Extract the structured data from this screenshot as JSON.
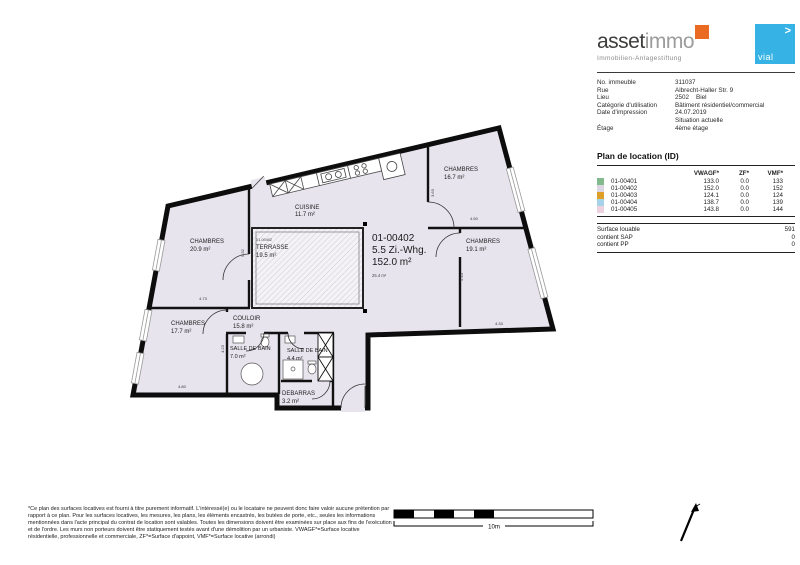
{
  "brand": {
    "wordmark_primary": "asset",
    "wordmark_secondary": "immo",
    "tagline": "Immobilien-Anlagestiftung",
    "accent_color": "#e96a20",
    "partner": {
      "text": "vial",
      "arrow": ">",
      "color": "#36b3e4"
    }
  },
  "property_info": {
    "rows": [
      {
        "label": "No. immeuble",
        "value": "311037"
      },
      {
        "label": "Rue",
        "value": "Albrecht-Haller Str. 9"
      },
      {
        "label": "Lieu",
        "value": "2502    Biel"
      },
      {
        "label": "Catégorie d'utilisation",
        "value": "Bâtiment résidentiel/commercial"
      },
      {
        "label": "Date d'impression",
        "value": "24.07.2019"
      },
      {
        "label": "",
        "value": "Situation actuelle"
      },
      {
        "label": "Étage",
        "value": "4ème étage"
      }
    ]
  },
  "location_table": {
    "title": "Plan de location (ID)",
    "columns": [
      "VWAGF*",
      "ZF*",
      "VMF*"
    ],
    "rows": [
      {
        "id": "01-00401",
        "color": "#82ba8e",
        "vwagf": "133.0",
        "zf": "0.0",
        "vmf": "133"
      },
      {
        "id": "01-00402",
        "color": "#dbd6e3",
        "vwagf": "152.0",
        "zf": "0.0",
        "vmf": "152"
      },
      {
        "id": "01-00403",
        "color": "#dd9f27",
        "vwagf": "124.1",
        "zf": "0.0",
        "vmf": "124"
      },
      {
        "id": "01-00404",
        "color": "#a6d3ea",
        "vwagf": "138.7",
        "zf": "0.0",
        "vmf": "139"
      },
      {
        "id": "01-00405",
        "color": "#ecd2de",
        "vwagf": "143.8",
        "zf": "0.0",
        "vmf": "144"
      }
    ],
    "summary": [
      {
        "label": "Surface louable",
        "value": "591"
      },
      {
        "label": "contient SAP",
        "value": "0"
      },
      {
        "label": "contient PP",
        "value": "0"
      }
    ]
  },
  "plan": {
    "unit": {
      "id": "01-00402",
      "type": "5.5 Zi.-Whg.",
      "area": "152.0 m²",
      "sub_area": "25.4 m²"
    },
    "rooms": [
      {
        "name": "CHAMBRES",
        "area": "20.9 m²"
      },
      {
        "name": "CUISINE",
        "area": "11.7 m²"
      },
      {
        "name": "TERRASSE",
        "area": "19.5 m²",
        "tag": "01-00402"
      },
      {
        "name": "CHAMBRES",
        "area": "16.7 m²"
      },
      {
        "name": "CHAMBRES",
        "area": "19.1 m²"
      },
      {
        "name": "CHAMBRES",
        "area": "17.7 m²"
      },
      {
        "name": "COULOIR",
        "area": "15.8 m²"
      },
      {
        "name": "SALLE DE BAIN",
        "area": "7.0 m²"
      },
      {
        "name": "SALLE DE BAIN",
        "area": "4.4 m²"
      },
      {
        "name": "DEBARRAS",
        "area": "3.2 m²"
      }
    ],
    "dimensions": [
      "5.32",
      "4.73",
      "4.80",
      "4.23",
      "3.63",
      "4.50",
      "5.10",
      "4.33"
    ],
    "scale_label": "10m",
    "fill_color": "#e8e4ee"
  },
  "disclaimer": "*Ce plan des surfaces locatives est fourni à titre purement informatif. L'intéressé(e) ou le locataire ne peuvent donc faire valoir aucune prétention par rapport à ce plan. Pour les surfaces locatives, les mesures, les plans, les éléments encastrés, les butées de porte, etc., seules les informations mentionnées dans l'acte principal du contrat de location sont valables. Toutes les dimensions doivent être examinées sur place aux fins de l'exécution et de l'ordre. Les murs non porteurs doivent être statiquement testés avant d'une démolition par un urbaniste. VWAGF*=Surface locative résidentielle, professionnelle et commerciale, ZF*=Surface d'appoint, VMF*=Surface locative (arrondi)"
}
